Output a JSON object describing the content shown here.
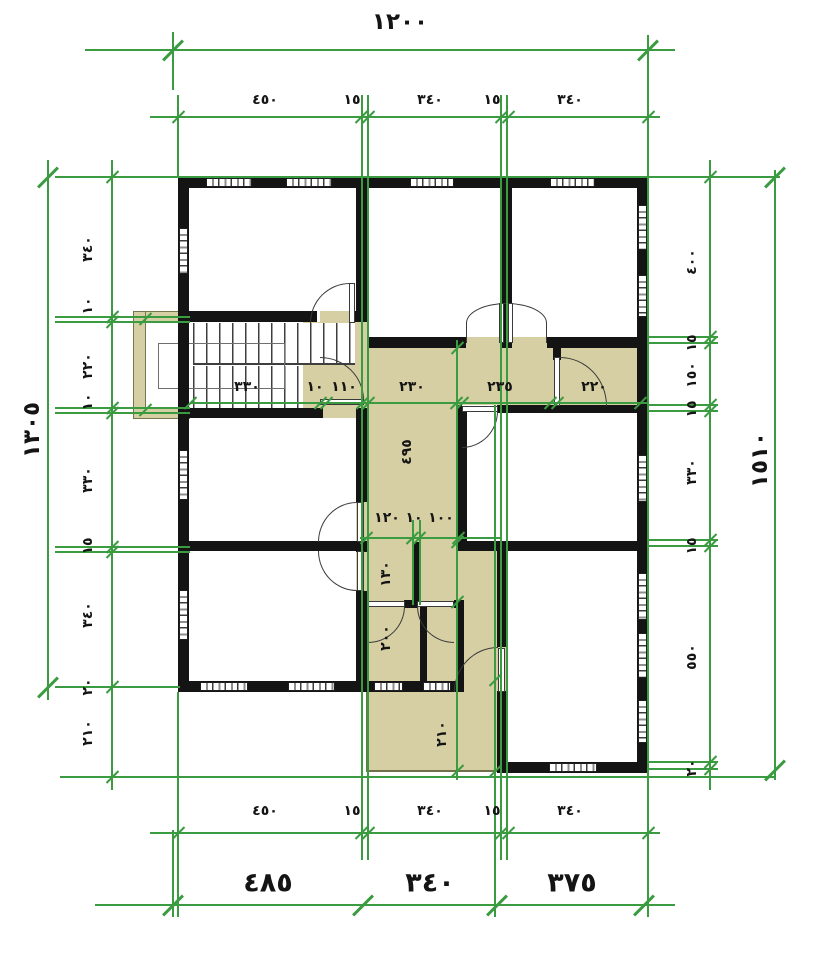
{
  "drawing_type": "architectural-floor-plan",
  "colors": {
    "wall": "#141414",
    "corridor_fill": "#d6cfa4",
    "dimension_lines": "#3b9b40",
    "dimension_text": "#141414"
  },
  "dimensions": {
    "top_total": "١٢٠٠",
    "top_row": [
      "٤٥٠",
      "١٥",
      "٣٤٠",
      "١٥",
      "٣٤٠"
    ],
    "left_total": "١٣٠٥",
    "left_col": [
      "٣٤٠",
      "١٠",
      "٢٢٠",
      "١٠",
      "٣٣٠",
      "١٥",
      "٣٤٠",
      "٢٠",
      "٢١٠"
    ],
    "right_total": "١٥١٠",
    "right_col": [
      "٤٠٠",
      "١٥",
      "١٥٠",
      "١٥",
      "٣٣٠",
      "١٥",
      "٥٥٠",
      "٢٠"
    ],
    "bottom_row": [
      "٤٥٠",
      "١٥",
      "٣٤٠",
      "١٥",
      "٣٤٠"
    ],
    "bottom_totals": [
      "٤٨٥",
      "٣٤٠",
      "٣٧٥"
    ],
    "corridor_row": [
      "٣٣٠",
      "١٠",
      "١١٠",
      "٢٣٠",
      "٢٣٥",
      "٢٢٠"
    ],
    "corridor_length": "٤٩٥",
    "sub_hall_row": [
      "١٢٠",
      "١٠",
      "١٠٠"
    ],
    "lower_hall": [
      "١٣٠",
      "٢٠٠"
    ],
    "porch_depth": "٢١٠"
  }
}
